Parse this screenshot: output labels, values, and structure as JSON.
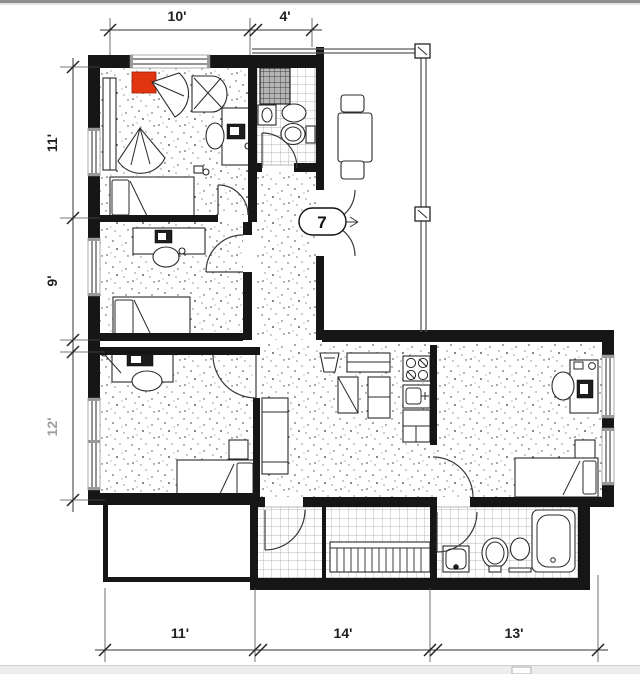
{
  "plan": {
    "door_tag": "7",
    "dims": {
      "top": [
        {
          "label": "10'"
        },
        {
          "label": "4'"
        }
      ],
      "left": [
        {
          "label": "11'"
        },
        {
          "label": "9'"
        },
        {
          "label": "12'"
        }
      ],
      "bottom": [
        {
          "label": "11'"
        },
        {
          "label": "14'"
        },
        {
          "label": "13'"
        }
      ]
    },
    "colors": {
      "highlight": "#e0350f",
      "dim_text": "#1f1f1f",
      "dim_muted": "#9e9e9e"
    }
  }
}
